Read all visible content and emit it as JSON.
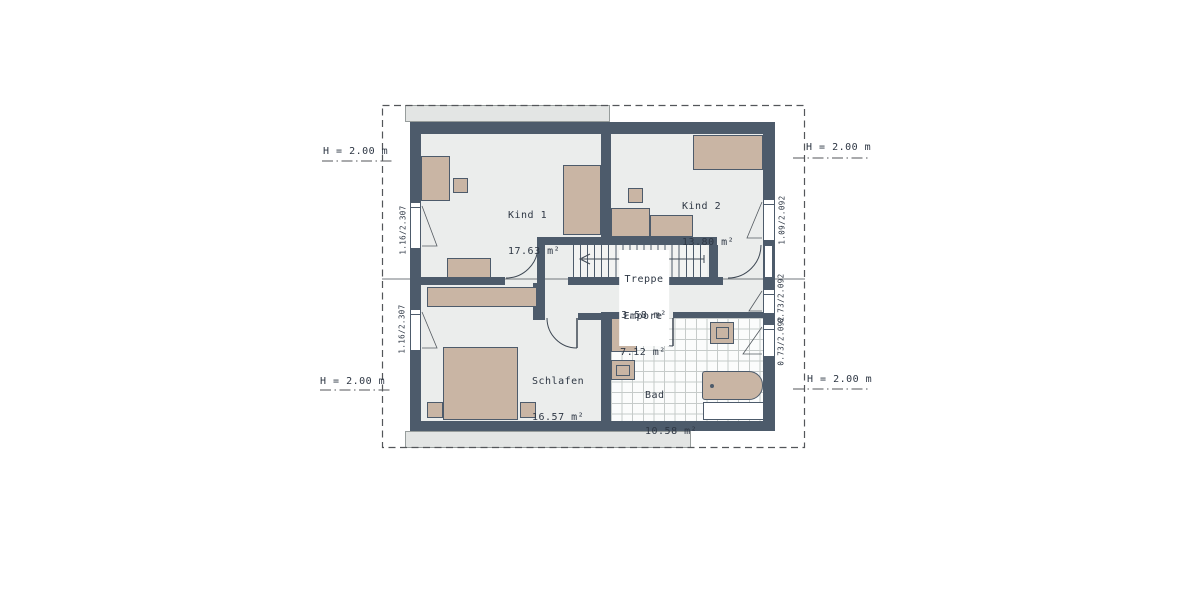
{
  "plan": {
    "type": "floor-plan-upper-storey",
    "rooms": [
      {
        "id": "kind1",
        "name": "Kind 1",
        "area": "17.63 m²"
      },
      {
        "id": "kind2",
        "name": "Kind 2",
        "area": "13.80 m²"
      },
      {
        "id": "treppe",
        "name": "Treppe",
        "area": "3.58 m²"
      },
      {
        "id": "empore",
        "name": "Empore",
        "area": "7.12 m²"
      },
      {
        "id": "schlafen",
        "name": "Schlafen",
        "area": "16.57 m²"
      },
      {
        "id": "bad",
        "name": "Bad",
        "area": "10.58 m²"
      }
    ],
    "height_labels": {
      "top_left": "H = 2.00 m",
      "top_right": "H = 2.00 m",
      "bottom_left": "H = 2.00 m",
      "bottom_right": "H = 2.00 m"
    },
    "window_labels": {
      "left_top": "1.16/2.307",
      "left_bottom": "1.16/2.307",
      "right_top": "1.09/2.092",
      "right_middle": "0.73/2.092",
      "right_bottom": "0.73/2.092"
    },
    "colors": {
      "wall": "#4d5b6b",
      "floor": "#ebedec",
      "furniture": "#c9b5a4",
      "roof": "#e3e5e4",
      "tile_line": "#c6cbca",
      "text": "#2e3744",
      "line": "#53565a"
    }
  }
}
